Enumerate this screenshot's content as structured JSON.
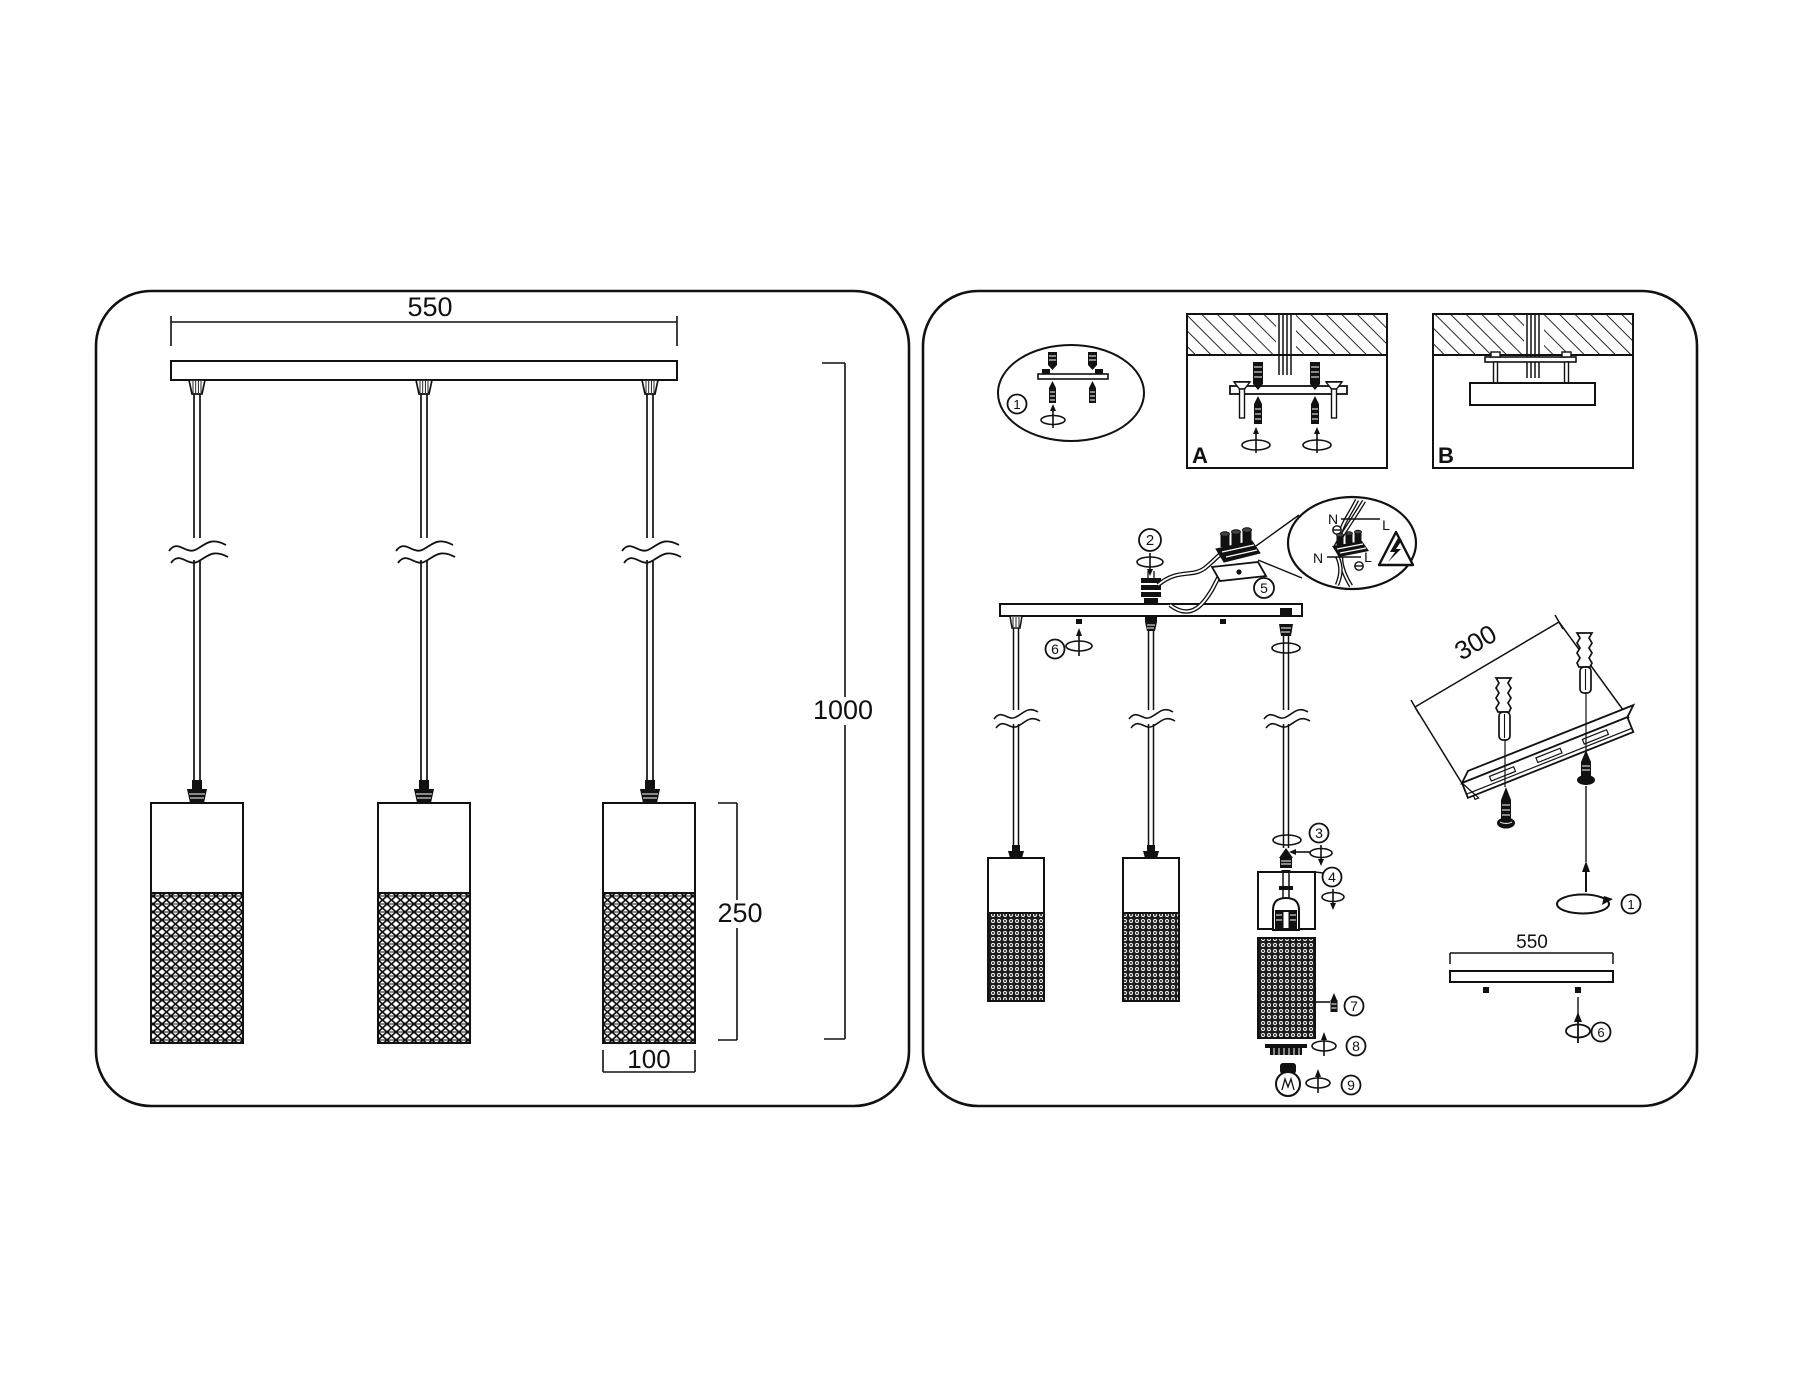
{
  "colors": {
    "ink": "#111111",
    "background": "#ffffff"
  },
  "left_diagram": {
    "bar_width_mm": "550",
    "overall_drop_mm": "1000",
    "shade_height_mm": "250",
    "shade_diameter_mm": "100"
  },
  "right_diagram": {
    "detail_circle_step": "1",
    "mount_option_a": "A",
    "mount_option_b": "B",
    "step_2": "2",
    "step_3": "3",
    "step_4": "4",
    "step_5": "5",
    "step_6": "6",
    "step_7": "7",
    "step_8": "8",
    "step_9": "9",
    "rail_length_mm": "300",
    "rail_step": "1",
    "canopy_width_mm": "550",
    "canopy_step": "6",
    "wiring": {
      "neutral_top": "N",
      "live_top": "L",
      "neutral_bottom": "N",
      "live_bottom": "L"
    }
  }
}
